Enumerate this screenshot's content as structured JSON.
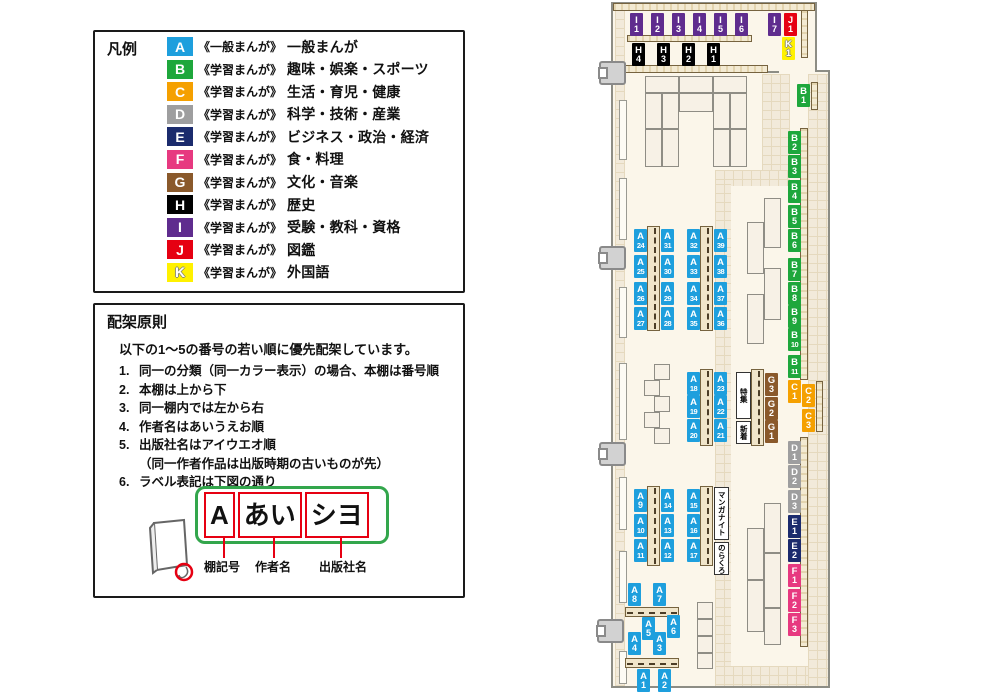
{
  "legend": {
    "title": "凡例",
    "items": [
      {
        "code": "A",
        "color": "#1E9FDD",
        "prefix": "《一般まんが》",
        "name": "一般まんが"
      },
      {
        "code": "B",
        "color": "#1EA73C",
        "prefix": "《学習まんが》",
        "name": "趣味・娯楽・スポーツ"
      },
      {
        "code": "C",
        "color": "#F5A000",
        "prefix": "《学習まんが》",
        "name": "生活・育児・健康"
      },
      {
        "code": "D",
        "color": "#9E9E9F",
        "prefix": "《学習まんが》",
        "name": "科学・技術・産業"
      },
      {
        "code": "E",
        "color": "#1B2B6D",
        "prefix": "《学習まんが》",
        "name": "ビジネス・政治・経済"
      },
      {
        "code": "F",
        "color": "#E73980",
        "prefix": "《学習まんが》",
        "name": "食・料理"
      },
      {
        "code": "G",
        "color": "#8A592B",
        "prefix": "《学習まんが》",
        "name": "文化・音楽"
      },
      {
        "code": "H",
        "color": "#000000",
        "prefix": "《学習まんが》",
        "name": "歴史"
      },
      {
        "code": "I",
        "color": "#5F2C8E",
        "prefix": "《学習まんが》",
        "name": "受験・教科・資格"
      },
      {
        "code": "J",
        "color": "#E60012",
        "prefix": "《学習まんが》",
        "name": "図鑑"
      },
      {
        "code": "K",
        "color": "#FFF100",
        "prefix": "《学習まんが》",
        "name": "外国語",
        "light": true
      }
    ]
  },
  "principles": {
    "title": "配架原則",
    "intro": "以下の1～5の番号の若い順に優先配架しています。",
    "items": [
      {
        "num": "1.",
        "text": "同一の分類（同一カラー表示）の場合、本棚は番号順"
      },
      {
        "num": "2.",
        "text": "本棚は上から下"
      },
      {
        "num": "3.",
        "text": "同一棚内では左から右"
      },
      {
        "num": "4.",
        "text": "作者名はあいうえお順"
      },
      {
        "num": "5.",
        "text": "出版社名はアイウエオ順",
        "note": "（同一作者作品は出版時期の古いものが先）"
      },
      {
        "num": "6.",
        "text": "ラベル表記は下図の通り"
      }
    ]
  },
  "label_diagram": {
    "boxes": [
      "A",
      "あい",
      "シヨ"
    ],
    "captions": [
      "棚記号",
      "作者名",
      "出版社名"
    ]
  },
  "map": {
    "shelf_labels": [
      {
        "id": "I1",
        "x": 630,
        "y": 13
      },
      {
        "id": "I2",
        "x": 651,
        "y": 13
      },
      {
        "id": "I3",
        "x": 672,
        "y": 13
      },
      {
        "id": "I4",
        "x": 693,
        "y": 13
      },
      {
        "id": "I5",
        "x": 714,
        "y": 13
      },
      {
        "id": "I6",
        "x": 735,
        "y": 13
      },
      {
        "id": "I7",
        "x": 768,
        "y": 13
      },
      {
        "id": "J1",
        "x": 784,
        "y": 13
      },
      {
        "id": "K1",
        "x": 782,
        "y": 37
      },
      {
        "id": "H4",
        "x": 632,
        "y": 43
      },
      {
        "id": "H3",
        "x": 657,
        "y": 43
      },
      {
        "id": "H2",
        "x": 682,
        "y": 43
      },
      {
        "id": "H1",
        "x": 707,
        "y": 43
      },
      {
        "id": "B1",
        "x": 797,
        "y": 84
      },
      {
        "id": "B2",
        "x": 788,
        "y": 131
      },
      {
        "id": "B3",
        "x": 788,
        "y": 155
      },
      {
        "id": "B4",
        "x": 788,
        "y": 180
      },
      {
        "id": "B5",
        "x": 788,
        "y": 205
      },
      {
        "id": "B6",
        "x": 788,
        "y": 229
      },
      {
        "id": "B7",
        "x": 788,
        "y": 258
      },
      {
        "id": "B8",
        "x": 788,
        "y": 282
      },
      {
        "id": "B9",
        "x": 788,
        "y": 305
      },
      {
        "id": "B10",
        "x": 788,
        "y": 328
      },
      {
        "id": "B11",
        "x": 788,
        "y": 355
      },
      {
        "id": "C1",
        "x": 788,
        "y": 380
      },
      {
        "id": "C2",
        "x": 802,
        "y": 384
      },
      {
        "id": "C3",
        "x": 802,
        "y": 409
      },
      {
        "id": "D1",
        "x": 788,
        "y": 441
      },
      {
        "id": "D2",
        "x": 788,
        "y": 465
      },
      {
        "id": "D3",
        "x": 788,
        "y": 490
      },
      {
        "id": "E1",
        "x": 788,
        "y": 515
      },
      {
        "id": "E2",
        "x": 788,
        "y": 539
      },
      {
        "id": "F1",
        "x": 788,
        "y": 564
      },
      {
        "id": "F2",
        "x": 788,
        "y": 589
      },
      {
        "id": "F3",
        "x": 788,
        "y": 613
      },
      {
        "id": "G3",
        "x": 765,
        "y": 373
      },
      {
        "id": "G2",
        "x": 765,
        "y": 397
      },
      {
        "id": "G1",
        "x": 765,
        "y": 420
      },
      {
        "id": "A24",
        "x": 634,
        "y": 229
      },
      {
        "id": "A25",
        "x": 634,
        "y": 255
      },
      {
        "id": "A26",
        "x": 634,
        "y": 282
      },
      {
        "id": "A27",
        "x": 634,
        "y": 307
      },
      {
        "id": "A31",
        "x": 661,
        "y": 229
      },
      {
        "id": "A30",
        "x": 661,
        "y": 255
      },
      {
        "id": "A29",
        "x": 661,
        "y": 282
      },
      {
        "id": "A28",
        "x": 661,
        "y": 307
      },
      {
        "id": "A32",
        "x": 687,
        "y": 229
      },
      {
        "id": "A33",
        "x": 687,
        "y": 255
      },
      {
        "id": "A34",
        "x": 687,
        "y": 282
      },
      {
        "id": "A35",
        "x": 687,
        "y": 307
      },
      {
        "id": "A39",
        "x": 714,
        "y": 229
      },
      {
        "id": "A38",
        "x": 714,
        "y": 255
      },
      {
        "id": "A37",
        "x": 714,
        "y": 282
      },
      {
        "id": "A36",
        "x": 714,
        "y": 307
      },
      {
        "id": "A18",
        "x": 687,
        "y": 372
      },
      {
        "id": "A19",
        "x": 687,
        "y": 395
      },
      {
        "id": "A20",
        "x": 687,
        "y": 419
      },
      {
        "id": "A23",
        "x": 714,
        "y": 372
      },
      {
        "id": "A22",
        "x": 714,
        "y": 395
      },
      {
        "id": "A21",
        "x": 714,
        "y": 419
      },
      {
        "id": "A9",
        "x": 634,
        "y": 489
      },
      {
        "id": "A10",
        "x": 634,
        "y": 514
      },
      {
        "id": "A11",
        "x": 634,
        "y": 539
      },
      {
        "id": "A14",
        "x": 661,
        "y": 489
      },
      {
        "id": "A13",
        "x": 661,
        "y": 514
      },
      {
        "id": "A12",
        "x": 661,
        "y": 539
      },
      {
        "id": "A15",
        "x": 687,
        "y": 489
      },
      {
        "id": "A16",
        "x": 687,
        "y": 514
      },
      {
        "id": "A17",
        "x": 687,
        "y": 539
      },
      {
        "id": "A8",
        "x": 628,
        "y": 583
      },
      {
        "id": "A7",
        "x": 653,
        "y": 583
      },
      {
        "id": "A5",
        "x": 642,
        "y": 617
      },
      {
        "id": "A6",
        "x": 667,
        "y": 615
      },
      {
        "id": "A4",
        "x": 628,
        "y": 632
      },
      {
        "id": "A3",
        "x": 653,
        "y": 632
      },
      {
        "id": "A1",
        "x": 637,
        "y": 669
      },
      {
        "id": "A2",
        "x": 658,
        "y": 669
      }
    ],
    "text_labels": [
      {
        "key": "tokushu",
        "text": "特集",
        "x": 736,
        "y": 372,
        "w": 15,
        "h": 47
      },
      {
        "key": "shinchaku",
        "text": "新着",
        "x": 736,
        "y": 421,
        "w": 15,
        "h": 23
      },
      {
        "key": "manga-night",
        "text": "マンガナイト",
        "x": 714,
        "y": 487,
        "w": 15,
        "h": 53
      },
      {
        "key": "norakuro",
        "text": "のらくろ",
        "x": 714,
        "y": 542,
        "w": 15,
        "h": 33
      }
    ]
  }
}
